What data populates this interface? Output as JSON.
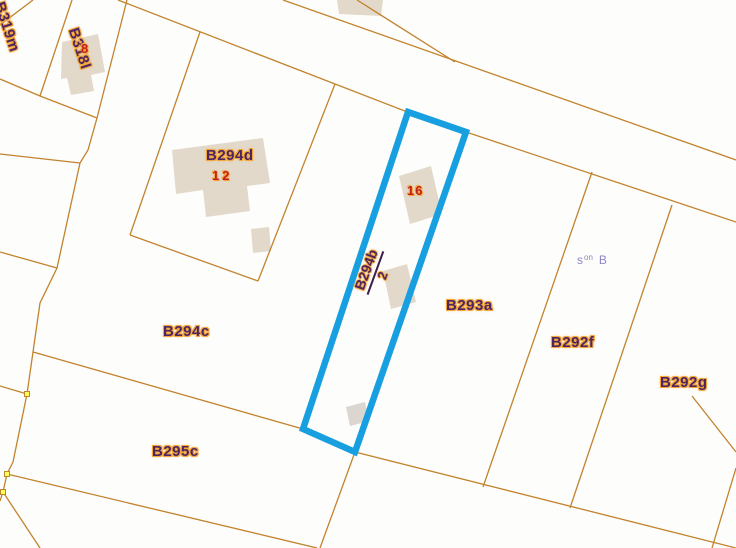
{
  "map": {
    "width": 736,
    "height": 548,
    "colors": {
      "background": "#fdfdfc",
      "boundary": "#c2832d",
      "building": "#e2d9cb",
      "building_alt": "#dbd6d0",
      "highlight": "#189fe0",
      "label": "#4f2560",
      "halo": "#f3a73b",
      "number": "#c41d1d",
      "note": "#9184c6",
      "marker_fill": "#ffff55",
      "marker_border": "#c2832d",
      "fraction_bar": "#3f1d4a"
    },
    "boundaries": [
      {
        "name": "road-upper-edge",
        "points": [
          [
            283,
            0
          ],
          [
            736,
            160
          ]
        ]
      },
      {
        "name": "road-lower-edge",
        "points": [
          [
            118,
            0
          ],
          [
            410,
            113
          ],
          [
            466,
            132
          ],
          [
            736,
            222
          ]
        ]
      },
      {
        "name": "cross-line-above-road",
        "points": [
          [
            357,
            0
          ],
          [
            455,
            62
          ]
        ]
      },
      {
        "name": "b319m-east-line",
        "points": [
          [
            33,
            0
          ],
          [
            0,
            25
          ]
        ]
      },
      {
        "name": "b318l-west-line",
        "points": [
          [
            72,
            0
          ],
          [
            40,
            96
          ]
        ]
      },
      {
        "name": "b318l-south-line",
        "points": [
          [
            0,
            79
          ],
          [
            40,
            96
          ],
          [
            97,
            118
          ]
        ]
      },
      {
        "name": "west-boundary-chain",
        "points": [
          [
            127,
            0
          ],
          [
            97,
            118
          ],
          [
            88,
            150
          ],
          [
            80,
            163
          ],
          [
            57,
            268
          ],
          [
            40,
            303
          ],
          [
            27,
            394
          ],
          [
            13,
            462
          ],
          [
            7,
            474
          ],
          [
            3,
            492
          ],
          [
            0,
            501
          ]
        ]
      },
      {
        "name": "west-branch-1",
        "points": [
          [
            80,
            163
          ],
          [
            0,
            154
          ]
        ]
      },
      {
        "name": "west-branch-2",
        "points": [
          [
            57,
            268
          ],
          [
            0,
            252
          ]
        ]
      },
      {
        "name": "west-branch-3",
        "points": [
          [
            27,
            394
          ],
          [
            0,
            386
          ]
        ]
      },
      {
        "name": "b294d-west-line",
        "points": [
          [
            200,
            32
          ],
          [
            130,
            235
          ]
        ]
      },
      {
        "name": "b294d-south-line",
        "points": [
          [
            130,
            235
          ],
          [
            258,
            281
          ]
        ]
      },
      {
        "name": "b294d-east-line",
        "points": [
          [
            258,
            281
          ],
          [
            335,
            84
          ]
        ]
      },
      {
        "name": "b294c-b295c-line",
        "points": [
          [
            33,
            352
          ],
          [
            303,
            429
          ],
          [
            355,
            452
          ],
          [
            736,
            548
          ]
        ]
      },
      {
        "name": "b295c-south-line",
        "points": [
          [
            7,
            474
          ],
          [
            317,
            548
          ]
        ]
      },
      {
        "name": "southwest-corner-line",
        "points": [
          [
            3,
            492
          ],
          [
            40,
            548
          ]
        ]
      },
      {
        "name": "parcel-tip-south-line",
        "points": [
          [
            355,
            452
          ],
          [
            320,
            548
          ]
        ]
      },
      {
        "name": "b293a-b292f-line",
        "points": [
          [
            592,
            172
          ],
          [
            483,
            487
          ]
        ]
      },
      {
        "name": "b292f-b292g-line",
        "points": [
          [
            672,
            205
          ],
          [
            570,
            508
          ]
        ]
      },
      {
        "name": "southeast-edge-line-1",
        "points": [
          [
            692,
            396
          ],
          [
            736,
            452
          ]
        ]
      },
      {
        "name": "southeast-edge-line-2",
        "points": [
          [
            736,
            468
          ],
          [
            712,
            548
          ]
        ]
      }
    ],
    "buildings": [
      {
        "name": "building-b318l",
        "points": [
          [
            62,
            42
          ],
          [
            98,
            34
          ],
          [
            105,
            72
          ],
          [
            91,
            75
          ],
          [
            94,
            91
          ],
          [
            71,
            95
          ],
          [
            67,
            78
          ],
          [
            61,
            79
          ]
        ],
        "fill": "default"
      },
      {
        "name": "building-top-center",
        "points": [
          [
            337,
            0
          ],
          [
            383,
            0
          ],
          [
            381,
            16
          ],
          [
            339,
            14
          ]
        ],
        "fill": "default"
      },
      {
        "name": "building-b294d-main",
        "points": [
          [
            172,
            150
          ],
          [
            263,
            138
          ],
          [
            270,
            183
          ],
          [
            247,
            186
          ],
          [
            250,
            211
          ],
          [
            206,
            217
          ],
          [
            203,
            190
          ],
          [
            176,
            194
          ]
        ],
        "fill": "default"
      },
      {
        "name": "building-b294d-annex",
        "points": [
          [
            251,
            229
          ],
          [
            269,
            227
          ],
          [
            271,
            251
          ],
          [
            253,
            253
          ]
        ],
        "fill": "default"
      },
      {
        "name": "building-house-16",
        "points": [
          [
            399,
            176
          ],
          [
            431,
            166
          ],
          [
            442,
            214
          ],
          [
            410,
            224
          ]
        ],
        "fill": "default"
      },
      {
        "name": "building-house-2",
        "points": [
          [
            383,
            271
          ],
          [
            407,
            264
          ],
          [
            416,
            302
          ],
          [
            391,
            309
          ]
        ],
        "fill": "default"
      },
      {
        "name": "building-b294b-shed",
        "points": [
          [
            346,
            407
          ],
          [
            365,
            402
          ],
          [
            369,
            421
          ],
          [
            350,
            426
          ]
        ],
        "fill": "alt"
      }
    ],
    "highlight": {
      "parcel": "B294b",
      "points": [
        [
          408,
          112
        ],
        [
          466,
          132
        ],
        [
          355,
          452
        ],
        [
          303,
          429
        ]
      ],
      "stroke_width": 6.5
    },
    "vertex_markers": [
      [
        27,
        394
      ],
      [
        7,
        474
      ],
      [
        3,
        492
      ]
    ],
    "parcel_labels": [
      {
        "text": "B319m",
        "x": 6,
        "y": 0,
        "rot": 72
      },
      {
        "text": "B318l",
        "x": 80,
        "y": 26,
        "rot": 72
      },
      {
        "text": "B294d",
        "x": 206,
        "y": 148,
        "rot": 0
      },
      {
        "text": "B294c",
        "x": 163,
        "y": 324,
        "rot": 0
      },
      {
        "text": "B295c",
        "x": 152,
        "y": 444,
        "rot": 0
      },
      {
        "text": "B293a",
        "x": 446,
        "y": 298,
        "rot": 0
      },
      {
        "text": "B292f",
        "x": 551,
        "y": 335,
        "rot": 0
      },
      {
        "text": "B292g",
        "x": 660,
        "y": 375,
        "rot": 0
      }
    ],
    "house_numbers": [
      {
        "text": "8",
        "x": 81,
        "y": 42,
        "spacing": 0
      },
      {
        "text": "12",
        "x": 212,
        "y": 169,
        "spacing": 3
      },
      {
        "text": "16",
        "x": 407,
        "y": 184,
        "spacing": 1
      }
    ],
    "fraction_label": {
      "numerator": "B294b",
      "denominator": "2"
    },
    "note_label": {
      "base": "s",
      "sup": "on",
      "rest": "B"
    }
  }
}
